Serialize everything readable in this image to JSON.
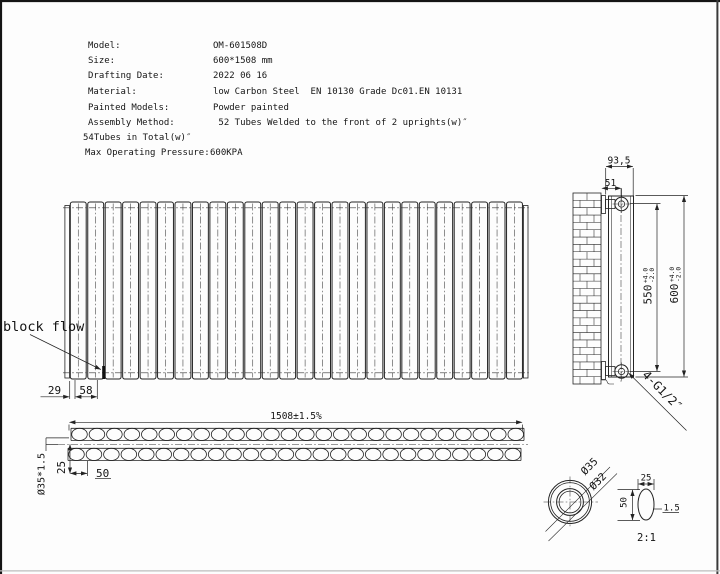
{
  "doc_title": "Radiator technical drawing",
  "spec_table": {
    "rows": [
      {
        "label": "Model:",
        "value": "OM-601508D"
      },
      {
        "label": "Size:",
        "value": "600*1508 mm"
      },
      {
        "label": "Drafting Date:",
        "value": "2022 06 16"
      },
      {
        "label": "Material:",
        "value": "low Carbon Steel  EN 10130 Grade Dc01.EN 10131"
      },
      {
        "label": "Painted Models:",
        "value": "Powder painted"
      },
      {
        "label": "Assembly Method:",
        "value": " 52 Tubes Welded to the front of 2 uprights(w)″"
      },
      {
        "label": "54Tubes in Total(w)″",
        "value": ""
      },
      {
        "label": "Max Operating Pressure:",
        "value": "600KPA"
      }
    ]
  },
  "front_view": {
    "annotation": "block flow",
    "dim_left_offset": "29",
    "dim_first_pitch": "58",
    "tube_count": 26
  },
  "top_view": {
    "dim_width": "1508±1.5%",
    "dim_tube_spec": "Ø35*1.5",
    "dim_row_offset": "25",
    "dim_pitch": "50",
    "oval_count_back": 26,
    "oval_count_front": 26
  },
  "side_view": {
    "dim_depth": "93,5",
    "dim_bracket": "51",
    "dim_hole_distance": {
      "value": "550",
      "tol_plus": "+4.0",
      "tol_minus": "-2.0"
    },
    "dim_height": {
      "value": "600",
      "tol_plus": "+4.0",
      "tol_minus": "-2.0"
    },
    "connection": "4-G1/2″"
  },
  "detail_view": {
    "dim_outer_dia": "Ø35",
    "dim_inner_dia": "Ø32",
    "dim_oval_width": "25",
    "dim_oval_height": "50",
    "dim_wall": "1.5",
    "scale": "2:1"
  },
  "colors": {
    "line": "#232323",
    "background": "#fdfdfd"
  }
}
